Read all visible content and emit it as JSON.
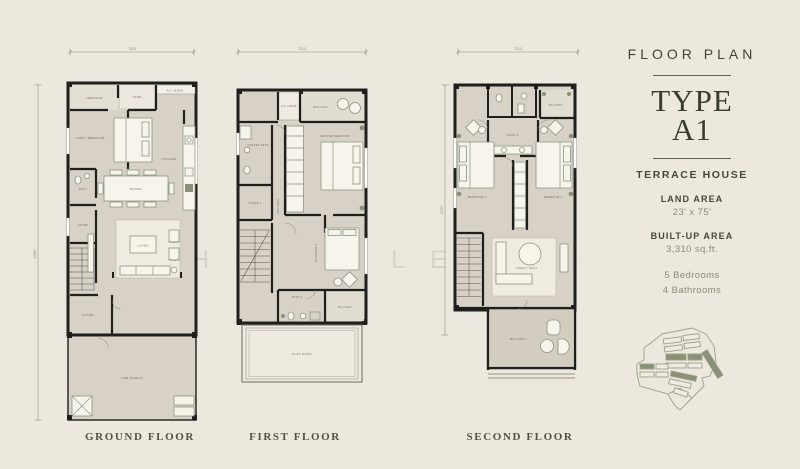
{
  "colors": {
    "background": "#EDE8DD",
    "floor": "#D8D2C6",
    "wall": "#1F1F1D",
    "furniture_outline": "#8A9480",
    "text_dark": "#3F4435",
    "text_muted": "#8E8A7A",
    "site_highlight": "#8A9176"
  },
  "watermark": {
    "text": "CHLOE LEONG"
  },
  "sidebar": {
    "heading": "FLOOR PLAN",
    "type_label": "TYPE",
    "type_value": "A1",
    "house_type": "TERRACE HOUSE",
    "land_area_label": "LAND AREA",
    "land_area_value": "23' x 75'",
    "built_up_label": "BUILT-UP AREA",
    "built_up_value": "3,310 sq.ft.",
    "bedrooms": "5 Bedrooms",
    "bathrooms": "4 Bathrooms"
  },
  "floors": {
    "ground": {
      "title": "GROUND FLOOR",
      "dims": {
        "width": "7010",
        "depth": "22860"
      },
      "rooms": {
        "terrace": "TERRACE",
        "yard": "YARD",
        "ac_ledge": "A/C LEDGE",
        "guest_bedroom": "GUEST BEDROOM",
        "kitchen": "KITCHEN",
        "dining": "DINING",
        "bath": "BATH",
        "store": "STORE",
        "living": "LIVING",
        "foyer": "FOYER",
        "car_porch": "CAR PORCH"
      }
    },
    "first": {
      "title": "FIRST FLOOR",
      "dims": {
        "width": "7010"
      },
      "rooms": {
        "ac_ledge": "A/C LEDGE",
        "balcony_front": "BALCONY",
        "master_bath": "MASTER BATH",
        "master_bedroom": "MASTER BEDROOM",
        "store": "STORE 2",
        "walkway": "WALKWAY",
        "bedroom2": "BEDROOM 2",
        "bath2": "BATH 2",
        "balcony_rear": "BALCONY",
        "flat_roof": "FLAT ROOF"
      }
    },
    "second": {
      "title": "SECOND FLOOR",
      "dims": {
        "width": "7010",
        "depth": "13720"
      },
      "rooms": {
        "bath3": "BATH 3",
        "balcony_front": "BALCONY",
        "bedroom3": "BEDROOM 3",
        "bedroom4": "BEDROOM 4",
        "family_hall": "FAMILY HALL",
        "balcony_rear": "BALCONY"
      }
    }
  }
}
